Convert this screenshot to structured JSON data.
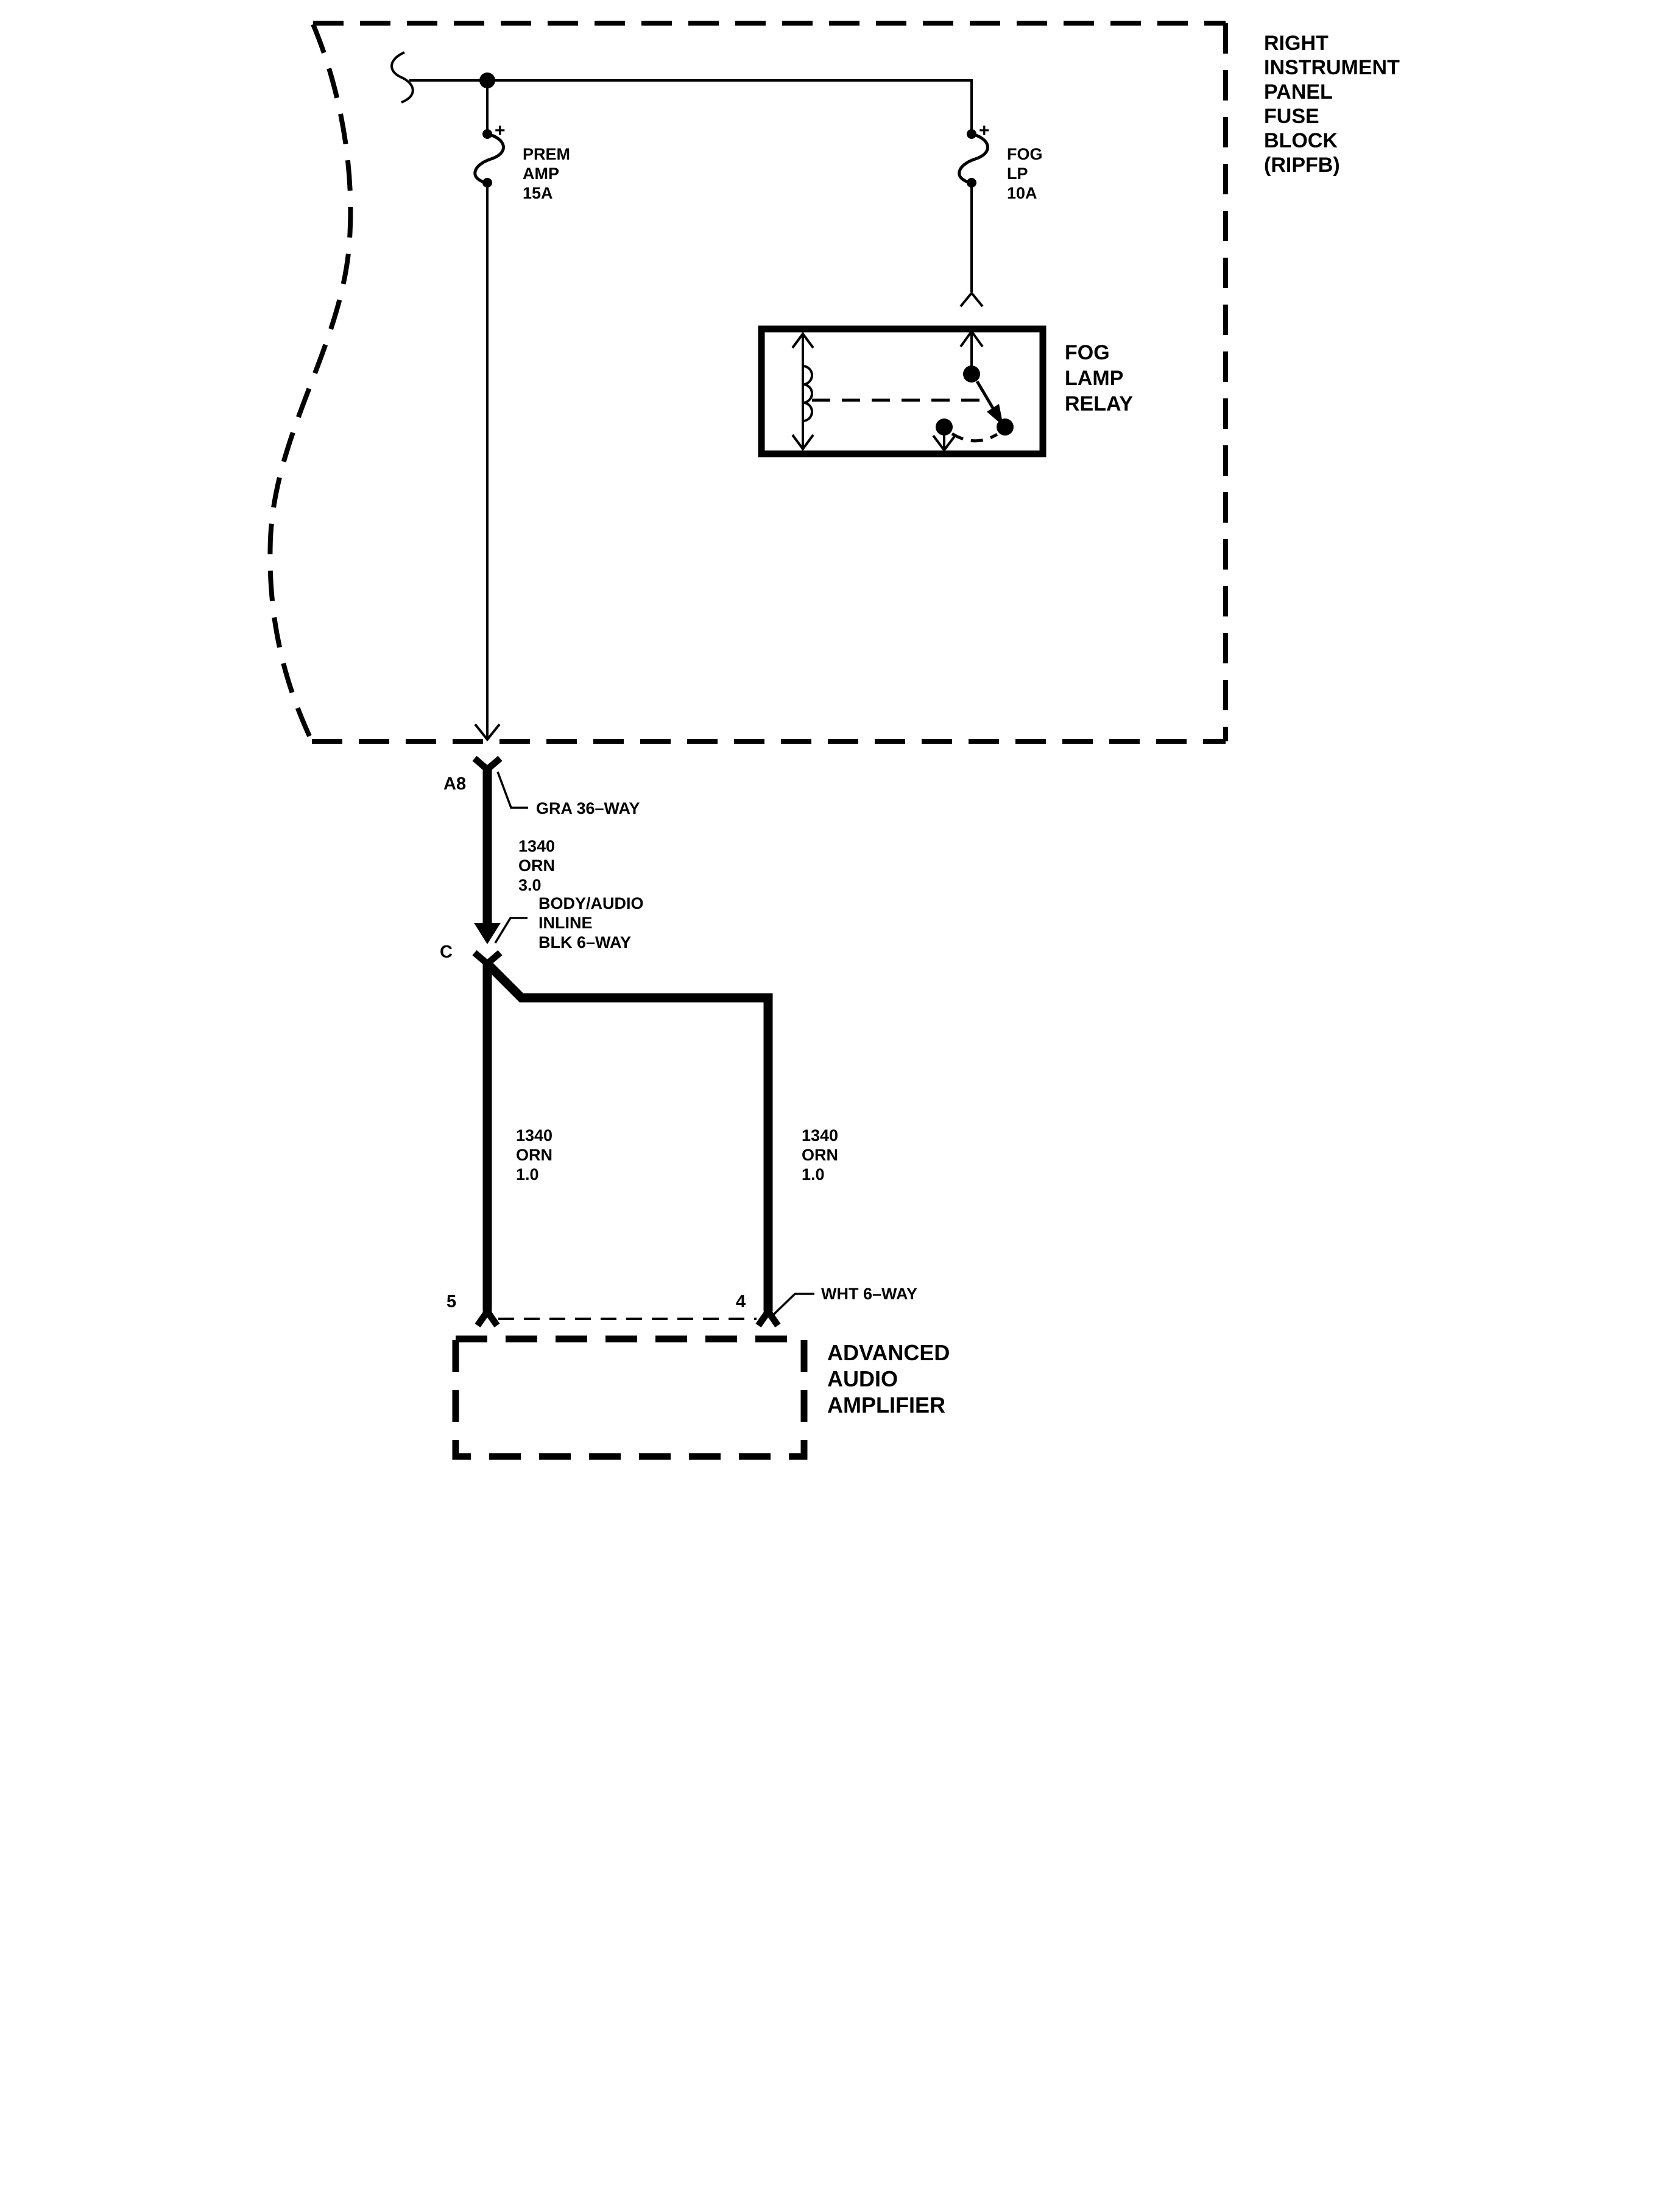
{
  "page": {
    "background": "#ffffff",
    "ink": "#000000"
  },
  "ripfb": {
    "title_lines": [
      "RIGHT",
      "INSTRUMENT",
      "PANEL",
      "FUSE",
      "BLOCK",
      "(RIPFB)"
    ]
  },
  "fuses": {
    "prem": {
      "plus": "+",
      "line1": "PREM",
      "line2": "AMP",
      "line3": "15A"
    },
    "fog": {
      "plus": "+",
      "line1": "FOG",
      "line2": "LP",
      "line3": "10A"
    }
  },
  "relay": {
    "line1": "FOG",
    "line2": "LAMP",
    "line3": "RELAY"
  },
  "connector_a8": {
    "pin": "A8",
    "label": "GRA 36–WAY"
  },
  "wire_a8": {
    "line1": "1340",
    "line2": "ORN",
    "line3": "3.0"
  },
  "connector_c": {
    "pin": "C",
    "label_line1": "BODY/AUDIO",
    "label_line2": "INLINE",
    "label_line3": "BLK 6–WAY"
  },
  "wire_left": {
    "line1": "1340",
    "line2": "ORN",
    "line3": "1.0"
  },
  "wire_right": {
    "line1": "1340",
    "line2": "ORN",
    "line3": "1.0"
  },
  "connector_amp": {
    "pin_left": "5",
    "pin_right": "4",
    "label": "WHT 6–WAY"
  },
  "amplifier": {
    "line1": "ADVANCED",
    "line2": "AUDIO",
    "line3": "AMPLIFIER"
  }
}
